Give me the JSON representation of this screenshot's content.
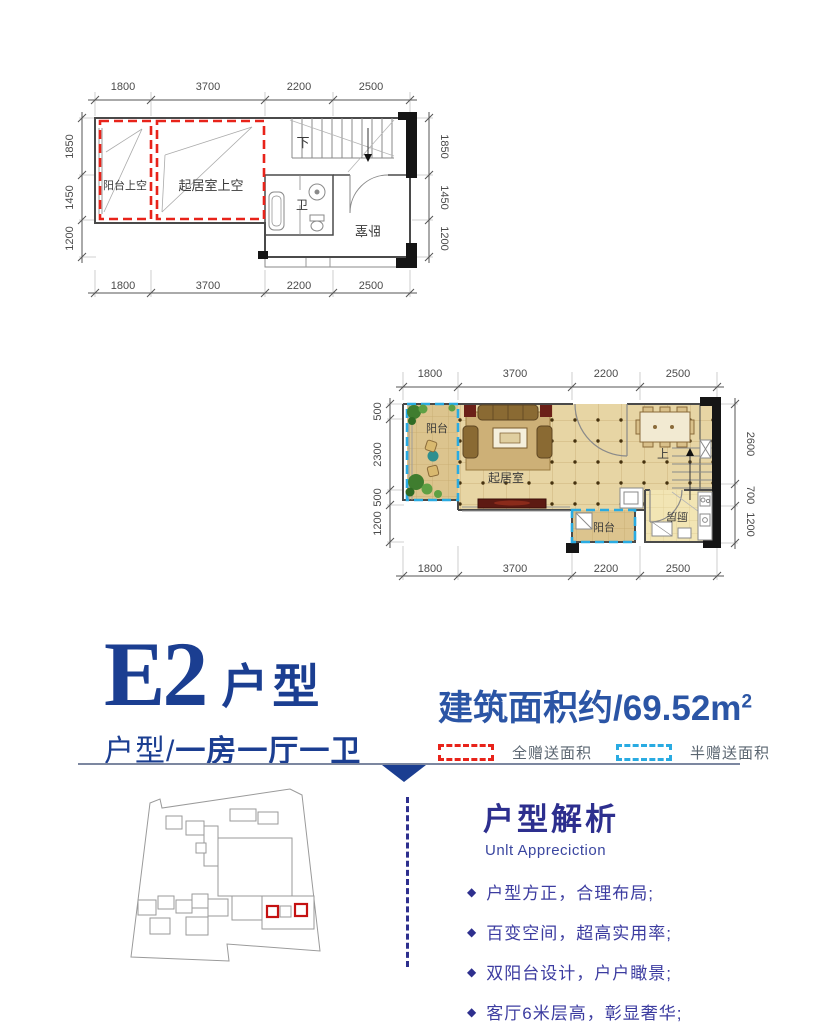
{
  "colors": {
    "accent_blue": "#1b3e91",
    "analysis_blue": "#2d2f8e",
    "full_gift_red": "#e8231a",
    "half_gift_blue": "#29abe2"
  },
  "plan_upper": {
    "dims_top": [
      "1800",
      "3700",
      "2200",
      "2500"
    ],
    "dims_bottom": [
      "1800",
      "3700",
      "2200",
      "2500"
    ],
    "dims_left": [
      "1850",
      "1450",
      "1200"
    ],
    "dims_right": [
      "1850",
      "1450",
      "1200"
    ],
    "rooms": {
      "balcony_void": "阳台上空",
      "living_void": "起居室上空",
      "bath": "卫",
      "bedroom": "卧室",
      "stair": "下"
    }
  },
  "plan_lower": {
    "dims_top": [
      "1800",
      "3700",
      "2200",
      "2500"
    ],
    "dims_bottom": [
      "1800",
      "3700",
      "2200",
      "2500"
    ],
    "dims_left": [
      "500",
      "2300",
      "500",
      "1200"
    ],
    "dims_right": [
      "2600",
      "700",
      "1200"
    ],
    "rooms": {
      "balcony_left": "阳台",
      "living": "起居室",
      "kitchen": "厨房",
      "balcony_bottom": "阳台",
      "stair": "上"
    }
  },
  "title_block": {
    "unit_code": "E2",
    "unit_label": "户型",
    "subtitle_prefix": "户型/",
    "subtitle_emphasis": "一房一厅一卫"
  },
  "area_block": {
    "text": "建筑面积约/69.52m",
    "superscript": "2"
  },
  "legend": {
    "full_gift_label": "全赠送面积",
    "half_gift_label": "半赠送面积"
  },
  "analysis": {
    "heading": "户型解析",
    "heading_en": "Unlt Appreciction",
    "bullet_icon": "◆",
    "bullets": [
      "户型方正，合理布局;",
      "百变空间，超高实用率;",
      "双阳台设计，户户瞰景;",
      "客厅6米层高，彰显奢华;"
    ]
  }
}
